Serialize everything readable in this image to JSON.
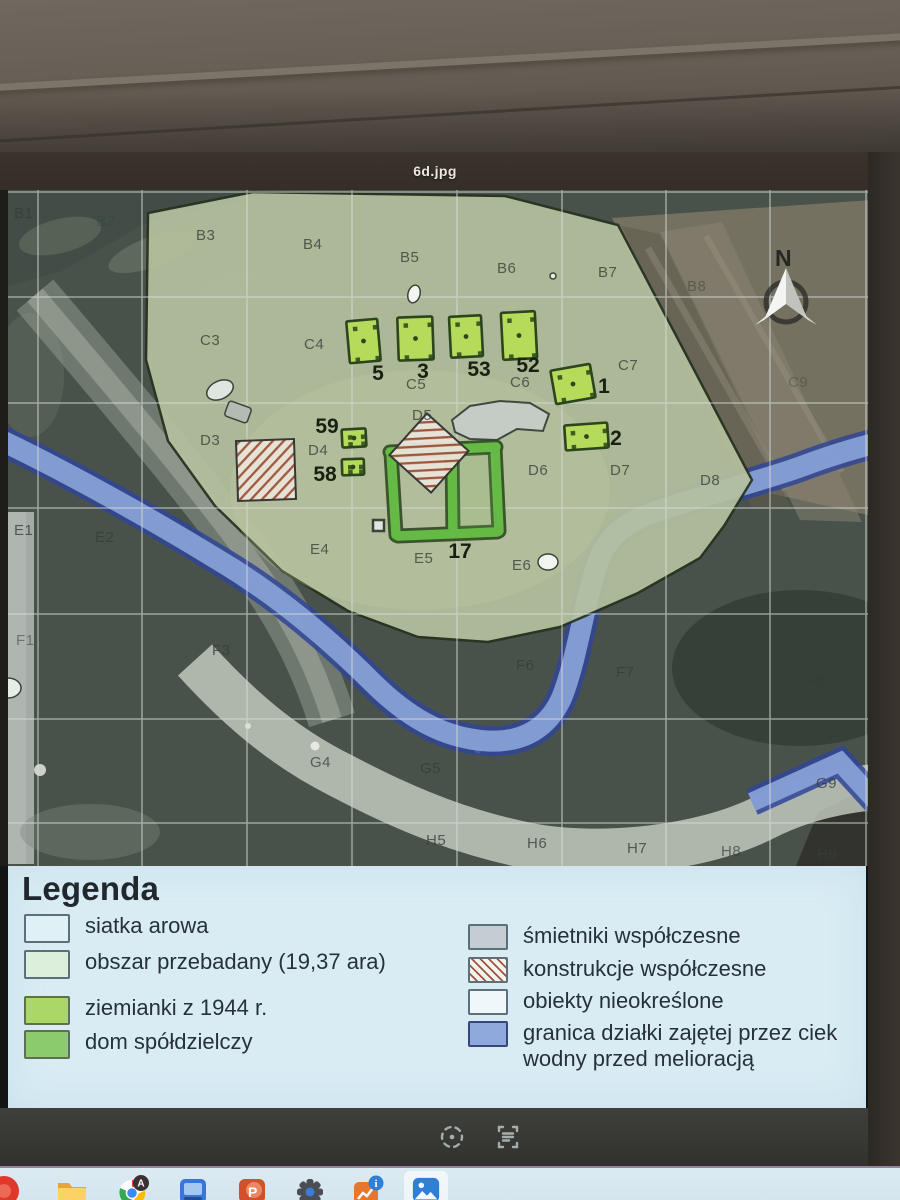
{
  "window": {
    "filename": "6d.jpg"
  },
  "colors": {
    "excavation_fill": "#b6c19e",
    "dugout_fill": "#b5dc55",
    "dugout_stroke": "#2a451c",
    "house_green": "#62bb40",
    "stream_fill": "#8aa5dc",
    "stream_edge": "#2f459b",
    "hatch_line": "#a0523a",
    "legend_bg": "#d9ecf4"
  },
  "map": {
    "north_label": "N",
    "grid_labels": [
      {
        "t": "B1",
        "x": 14,
        "y": 28,
        "o": 0.8
      },
      {
        "t": "B2",
        "x": 96,
        "y": 36,
        "o": 0.3
      },
      {
        "t": "B3",
        "x": 196,
        "y": 50
      },
      {
        "t": "B4",
        "x": 303,
        "y": 59
      },
      {
        "t": "B5",
        "x": 400,
        "y": 72
      },
      {
        "t": "B6",
        "x": 497,
        "y": 83
      },
      {
        "t": "B7",
        "x": 598,
        "y": 87
      },
      {
        "t": "B8",
        "x": 687,
        "y": 101,
        "o": 0.5
      },
      {
        "t": "C3",
        "x": 200,
        "y": 155
      },
      {
        "t": "C4",
        "x": 304,
        "y": 159
      },
      {
        "t": "C5",
        "x": 406,
        "y": 199
      },
      {
        "t": "C6",
        "x": 510,
        "y": 197
      },
      {
        "t": "C7",
        "x": 618,
        "y": 180
      },
      {
        "t": "C9",
        "x": 788,
        "y": 197,
        "o": 0.4
      },
      {
        "t": "D3",
        "x": 200,
        "y": 255
      },
      {
        "t": "D4",
        "x": 308,
        "y": 265
      },
      {
        "t": "D5",
        "x": 412,
        "y": 230
      },
      {
        "t": "D6",
        "x": 528,
        "y": 285
      },
      {
        "t": "D7",
        "x": 610,
        "y": 285
      },
      {
        "t": "D8",
        "x": 700,
        "y": 295
      },
      {
        "t": "E1",
        "x": 14,
        "y": 345
      },
      {
        "t": "E2",
        "x": 95,
        "y": 352
      },
      {
        "t": "E4",
        "x": 310,
        "y": 364
      },
      {
        "t": "E5",
        "x": 414,
        "y": 373
      },
      {
        "t": "E6",
        "x": 512,
        "y": 380
      },
      {
        "t": "F1",
        "x": 16,
        "y": 455,
        "o": 0.55
      },
      {
        "t": "F3",
        "x": 212,
        "y": 465
      },
      {
        "t": "F6",
        "x": 516,
        "y": 480
      },
      {
        "t": "F7",
        "x": 616,
        "y": 487
      },
      {
        "t": "F9",
        "x": 806,
        "y": 496,
        "o": 0.7
      },
      {
        "t": "G4",
        "x": 310,
        "y": 577,
        "o": 0.75
      },
      {
        "t": "G5",
        "x": 420,
        "y": 583
      },
      {
        "t": "G9",
        "x": 816,
        "y": 598
      },
      {
        "t": "H5",
        "x": 426,
        "y": 655
      },
      {
        "t": "H6",
        "x": 527,
        "y": 658
      },
      {
        "t": "H7",
        "x": 627,
        "y": 663
      },
      {
        "t": "H8",
        "x": 721,
        "y": 666,
        "o": 0.7
      },
      {
        "t": "H9",
        "x": 817,
        "y": 669,
        "o": 0.8
      }
    ],
    "dugouts": [
      {
        "label": "5",
        "x": 348,
        "y": 130,
        "w": 31,
        "h": 42,
        "r": -5
      },
      {
        "label": "3",
        "x": 398,
        "y": 127,
        "w": 35,
        "h": 43,
        "r": -2
      },
      {
        "label": "53",
        "x": 450,
        "y": 126,
        "w": 32,
        "h": 41,
        "r": -3
      },
      {
        "label": "52",
        "x": 502,
        "y": 122,
        "w": 34,
        "h": 47,
        "r": -3
      },
      {
        "label": "1",
        "x": 553,
        "y": 177,
        "w": 40,
        "h": 34,
        "r": -10
      },
      {
        "label": "2",
        "x": 565,
        "y": 234,
        "w": 43,
        "h": 25,
        "r": -4
      },
      {
        "label": "59",
        "x": 342,
        "y": 239,
        "w": 24,
        "h": 18,
        "r": -3
      },
      {
        "label": "58",
        "x": 342,
        "y": 269,
        "w": 22,
        "h": 16,
        "r": -2
      }
    ],
    "feature_labels": [
      {
        "t": "5",
        "x": 378,
        "y": 190
      },
      {
        "t": "3",
        "x": 423,
        "y": 188
      },
      {
        "t": "53",
        "x": 479,
        "y": 186
      },
      {
        "t": "52",
        "x": 528,
        "y": 182
      },
      {
        "t": "1",
        "x": 604,
        "y": 203
      },
      {
        "t": "2",
        "x": 616,
        "y": 255
      },
      {
        "t": "59",
        "x": 327,
        "y": 243
      },
      {
        "t": "58",
        "x": 325,
        "y": 291
      },
      {
        "t": "17",
        "x": 460,
        "y": 368
      }
    ]
  },
  "legend": {
    "title": "Legenda",
    "left_items": [
      {
        "name": "siatka-arowa",
        "label": "siatka arowa",
        "color": "#dff0f7",
        "border": "#5d6f7a"
      },
      {
        "name": "obszar-przebadany",
        "label": "obszar przebadany (19,37 ara)",
        "color": "#dcefdb",
        "border": "#5d6f7a"
      },
      {
        "name": "ziemianki-1944",
        "label": "ziemianki z 1944 r.",
        "color": "#a9d869",
        "border": "#5d7052"
      },
      {
        "name": "dom-spoldzielczy",
        "label": "dom spółdzielczy",
        "color": "#8bca6d",
        "border": "#5d7052"
      }
    ],
    "right_items": [
      {
        "name": "smietniki-wspolczesne",
        "label": "śmietniki współczesne",
        "color": "#c4ced2",
        "border": "#5d6f7a"
      },
      {
        "name": "konstrukcje-wspolczesne",
        "label": "konstrukcje współczesne",
        "color": "hatch",
        "border": "#5d6f7a"
      },
      {
        "name": "obiekty-nieokreslone",
        "label": "obiekty nieokreślone",
        "color": "#eef7fa",
        "border": "#5d6f7a"
      },
      {
        "name": "granica-cieku-wodnego",
        "label": "granica działki zajętej przez ciek wodny przed melioracją",
        "color": "#8fa9dd",
        "border": "#37477e"
      }
    ]
  },
  "viewer_toolbar": {
    "icons": [
      {
        "name": "focus-scan-icon"
      },
      {
        "name": "text-extract-icon"
      }
    ]
  },
  "taskbar": {
    "icons": [
      {
        "name": "browser-icon"
      },
      {
        "name": "file-explorer-icon"
      },
      {
        "name": "chrome-icon"
      },
      {
        "name": "media-app-icon"
      },
      {
        "name": "powerpoint-icon"
      },
      {
        "name": "settings-gear-icon"
      },
      {
        "name": "office-info-icon"
      },
      {
        "name": "photos-icon"
      }
    ]
  }
}
